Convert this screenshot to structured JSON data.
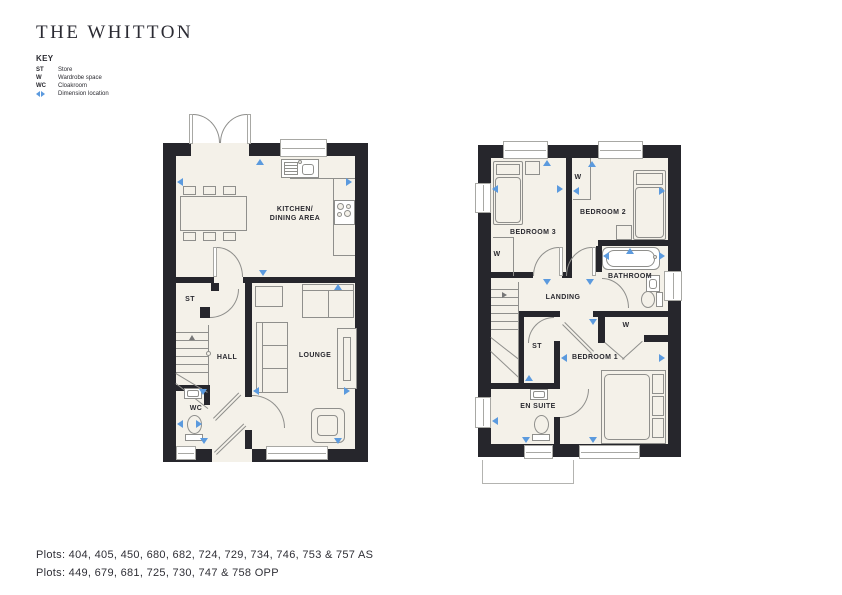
{
  "title": "THE WHITTON",
  "key": {
    "heading": "KEY",
    "items": [
      {
        "abbr": "ST",
        "label": "Store"
      },
      {
        "abbr": "W",
        "label": "Wardrobe space"
      },
      {
        "abbr": "WC",
        "label": "Cloakroom"
      },
      {
        "abbr": "",
        "label": "Dimension location",
        "icon": "dimension-arrows"
      }
    ]
  },
  "ground_floor": {
    "labels": {
      "kitchen": "KITCHEN/\nDINING AREA",
      "store": "ST",
      "hall": "HALL",
      "wc": "WC",
      "lounge": "LOUNGE"
    }
  },
  "first_floor": {
    "labels": {
      "bedroom3": "BEDROOM 3",
      "bedroom2": "BEDROOM 2",
      "bathroom": "BATHROOM",
      "landing": "LANDING",
      "store": "ST",
      "wardrobe": "W",
      "bedroom1": "BEDROOM 1",
      "ensuite": "EN SUITE"
    }
  },
  "plots": {
    "line1": "Plots: 404, 405, 450, 680, 682, 724, 729, 734, 746, 753 & 757 AS",
    "line2": "Plots: 449, 679, 681, 725, 730, 747 & 758 OPP"
  },
  "colors": {
    "wall": "#26262c",
    "floor": "#f4f1e9",
    "accent_blue": "#5b9ade",
    "line": "#8f8f8c"
  }
}
